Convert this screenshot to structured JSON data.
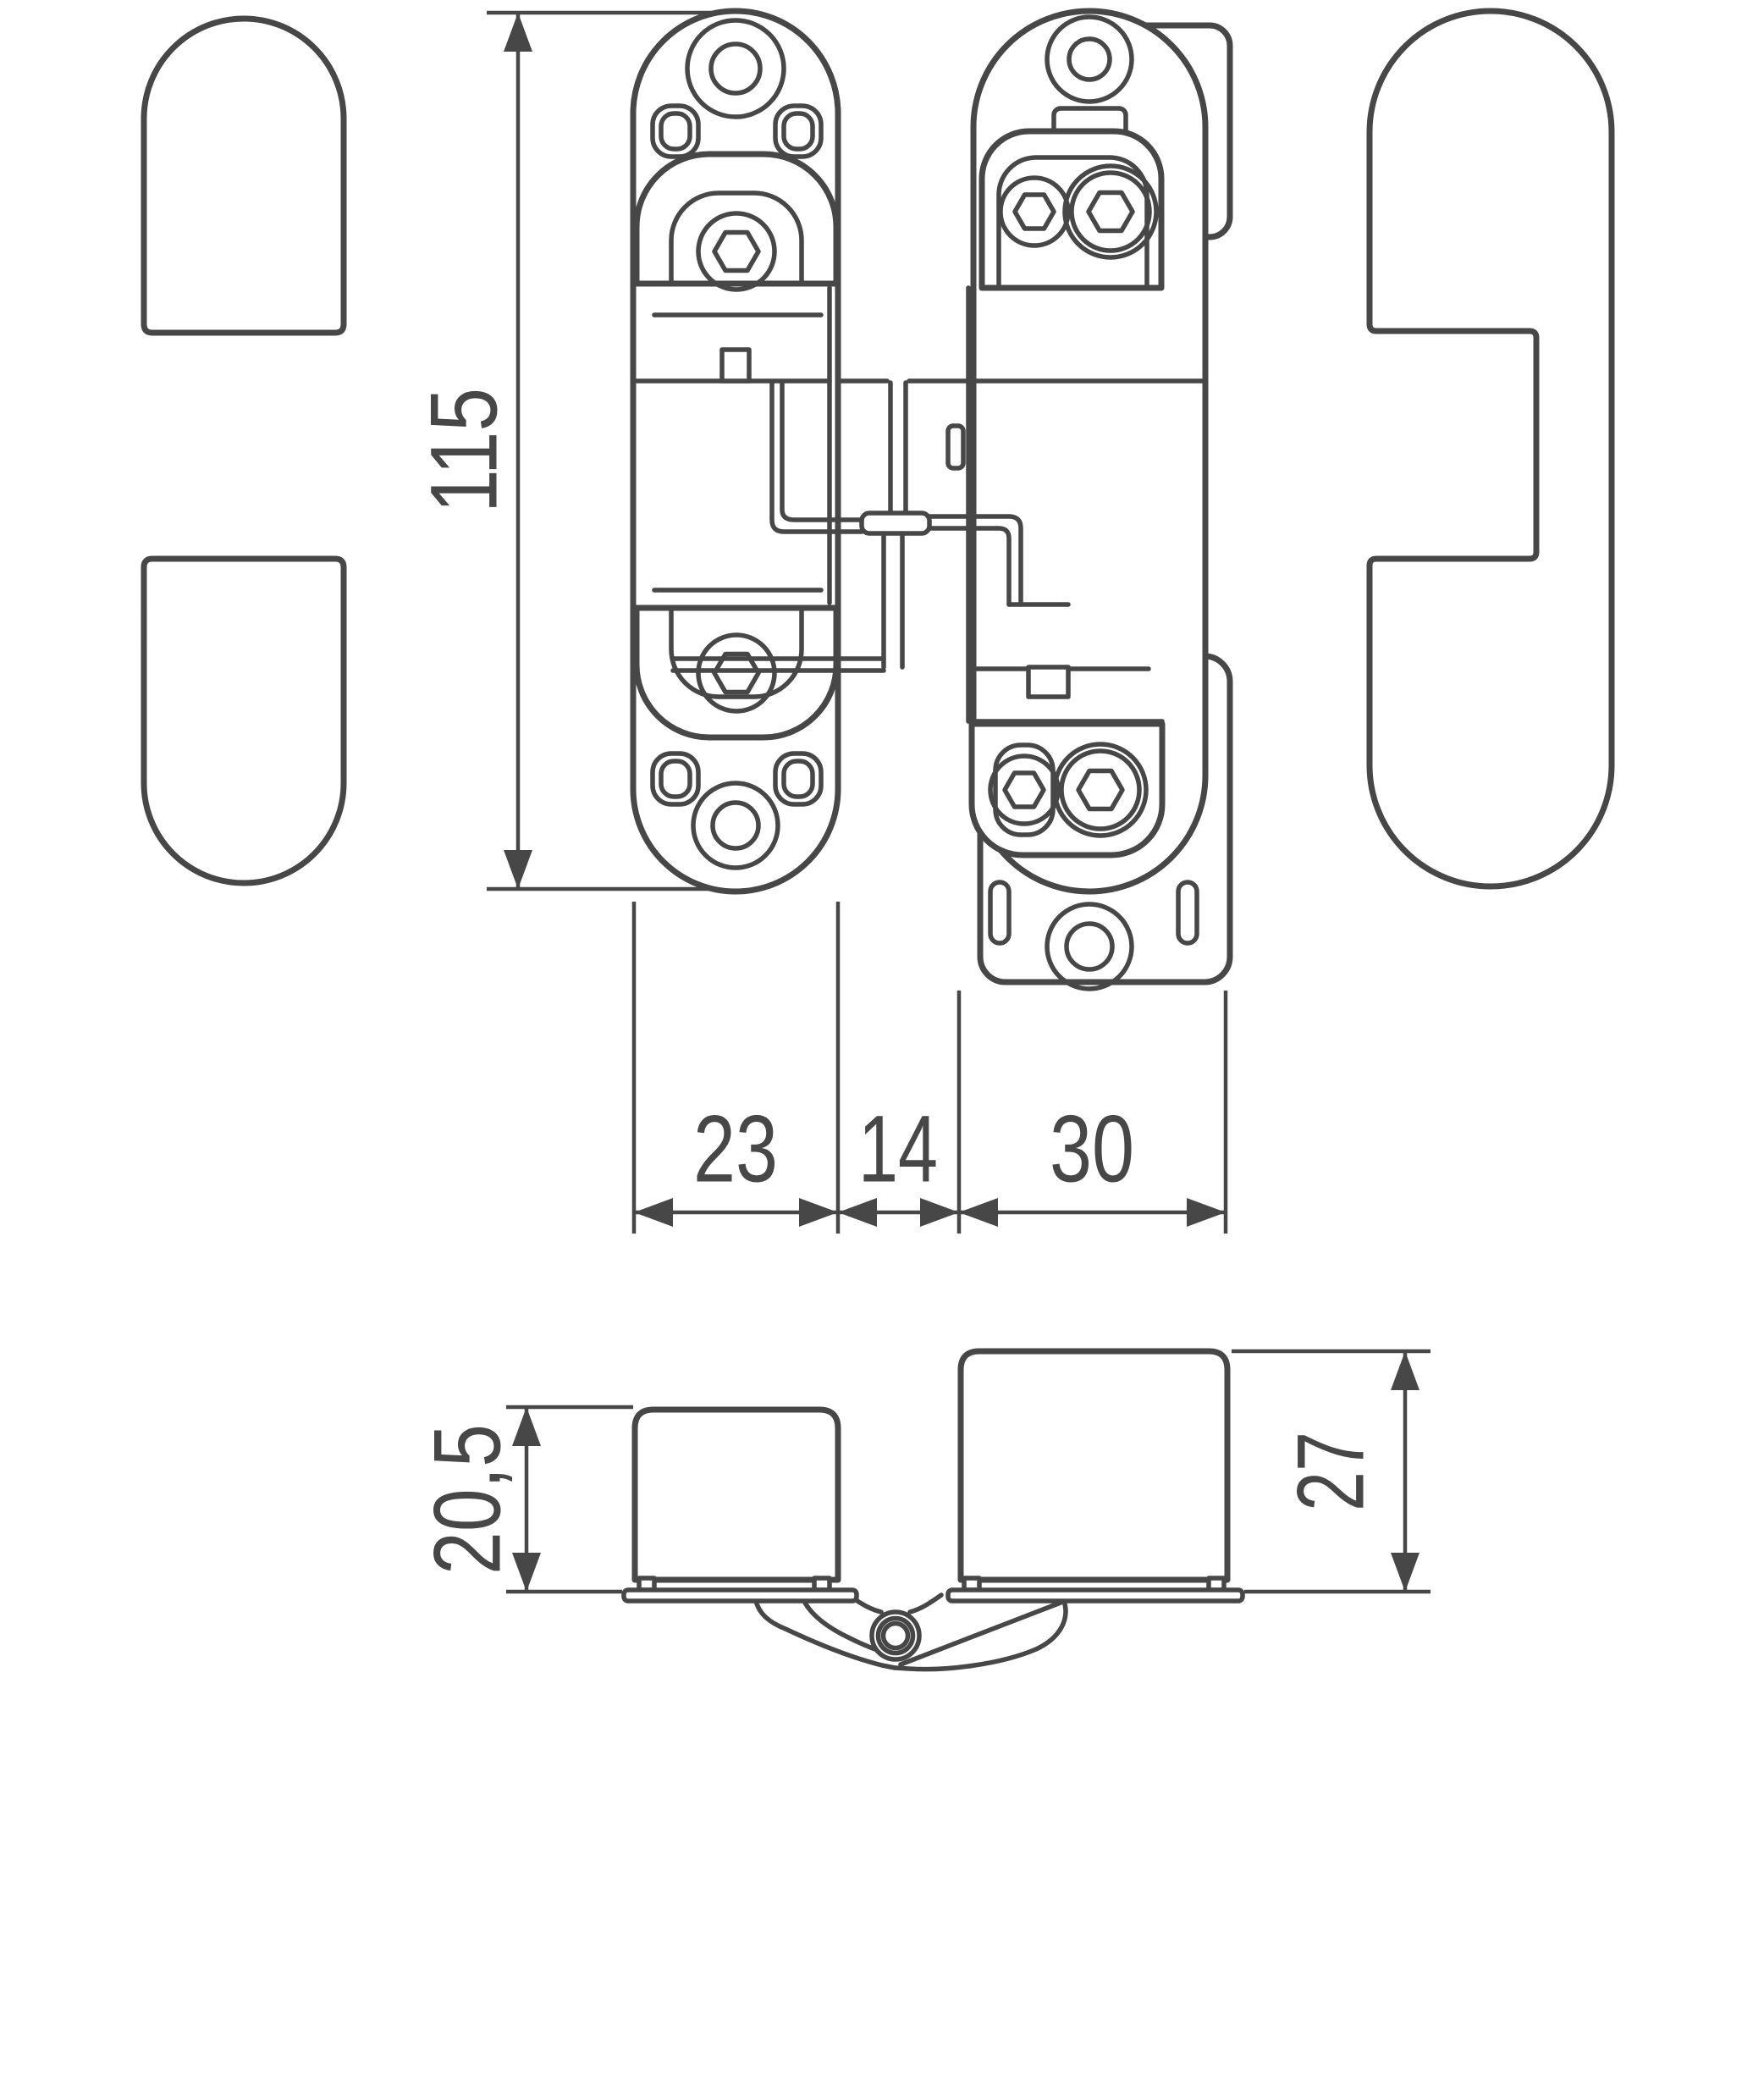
{
  "theme": {
    "line-color": "#474747",
    "background": "#ffffff"
  },
  "drawing": {
    "type": "technical-drawing",
    "subject": "concealed-hinge",
    "views": {
      "front_view": {
        "dimensions": {
          "height": {
            "label": "115"
          },
          "door_leaf_width": {
            "label": "23"
          },
          "center_gap": {
            "label": "14"
          },
          "frame_leaf_width": {
            "label": "30"
          }
        },
        "parts": [
          "cover-cap-top",
          "cover-cap-bottom",
          "door-leaf-plate",
          "frame-leaf-plate",
          "frame-side-cover-cap",
          "hinge-linkage"
        ]
      },
      "section_view": {
        "dimensions": {
          "door_cup_depth": {
            "label": "20,5"
          },
          "frame_cup_depth": {
            "label": "27"
          }
        },
        "parts": [
          "door-cup",
          "frame-cup",
          "pivot-knuckle"
        ]
      }
    }
  }
}
